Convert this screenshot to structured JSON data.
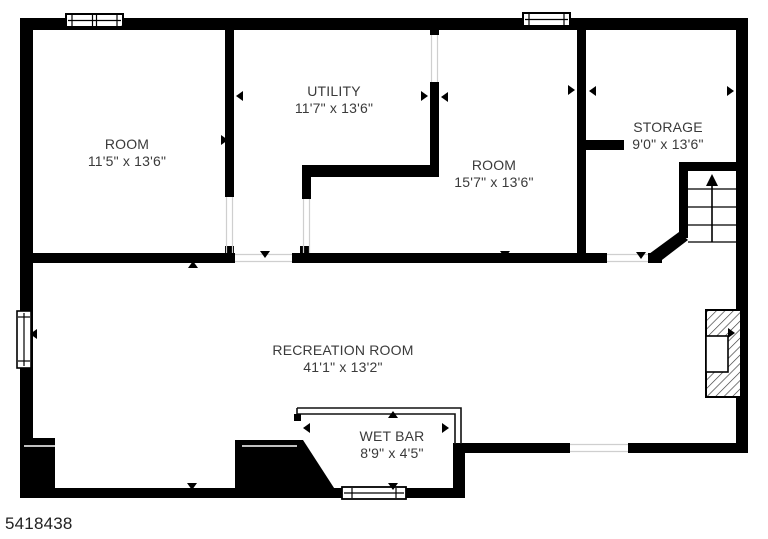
{
  "floorplan": {
    "listing_id": "5418438",
    "rooms": [
      {
        "name": "ROOM",
        "dimensions": "11'5\" x 13'6\""
      },
      {
        "name": "UTILITY",
        "dimensions": "11'7\" x 13'6\""
      },
      {
        "name": "ROOM",
        "dimensions": "15'7\" x 13'6\""
      },
      {
        "name": "STORAGE",
        "dimensions": "9'0\" x 13'6\""
      },
      {
        "name": "RECREATION ROOM",
        "dimensions": "41'1\" x 13'2\""
      },
      {
        "name": "WET BAR",
        "dimensions": "8'9\" x 4'5\""
      }
    ],
    "features": [
      "stairs-up",
      "fireplace",
      "windows",
      "wet-bar-counter"
    ],
    "colors": {
      "wall": "#000000",
      "background": "#ffffff",
      "label_text": "#3a3a3a",
      "hatch": "#3c3c3c",
      "door_gap_line": "#cfcfcf"
    }
  }
}
